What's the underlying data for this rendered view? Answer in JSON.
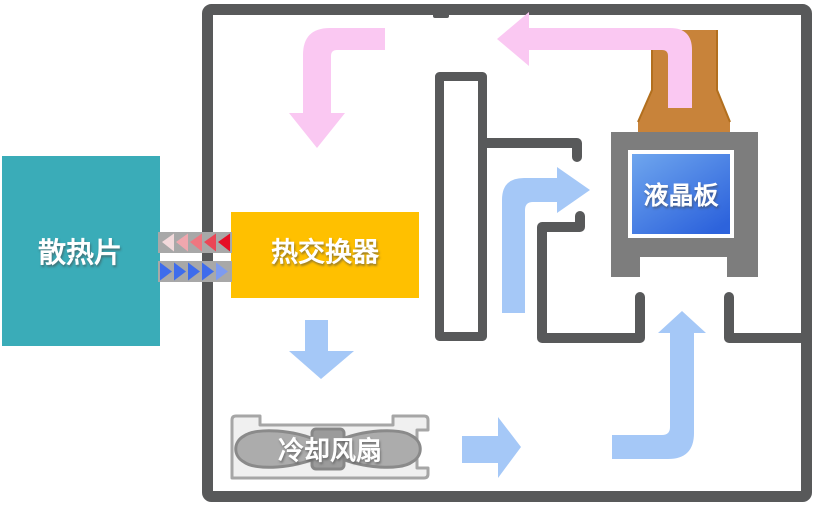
{
  "diagram": {
    "kind": "cooling-airflow-schematic",
    "labels": {
      "heatsink": "散热片",
      "heat_exchanger": "热交换器",
      "lcd_panel": "液晶板",
      "cooling_fan": "冷却风扇"
    },
    "colors": {
      "wall": "#58595A",
      "heatsink": "#3AACB8",
      "heat_exchanger": "#FFC000",
      "panel_frame": "#7D7D7D",
      "screen_top": "#6FA6EE",
      "screen_bottom": "#2D63DC",
      "duct": "#C8833A",
      "duct_edge": "#B26F1E",
      "hot_arrow": "#FAC8F2",
      "cold_arrow": "#A5C8F7",
      "connector_bar": "#A8A8A8",
      "fan_body": "#F0F0F0",
      "fan_body_edge": "#A6A6A6",
      "fan_blade": "#ACACAC",
      "fan_blade_edge": "#8A8A8A",
      "fan_hub": "#9B9B9B",
      "hot_triangles": [
        "#F2D9DB",
        "#F0A7AE",
        "#EE7680",
        "#EA4656",
        "#E60E26"
      ],
      "cold_triangles": [
        "#3E6CEC",
        "#3E6CEC",
        "#3E6CEC",
        "#3E6CEC",
        "#7D9BF0"
      ]
    }
  }
}
